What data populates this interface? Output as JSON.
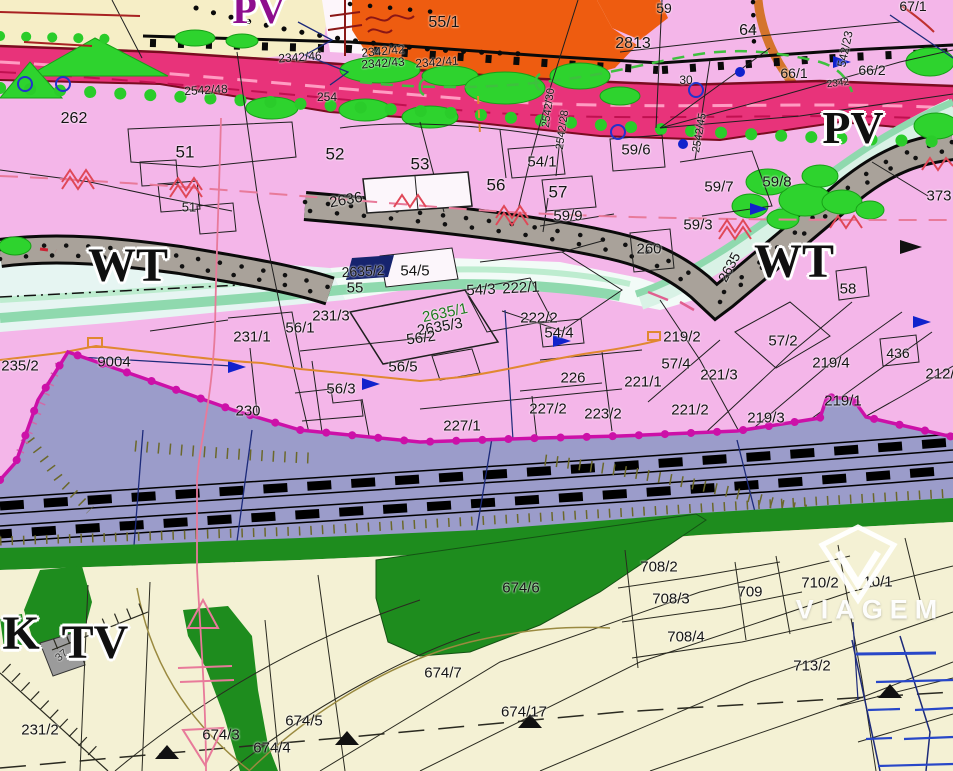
{
  "theme": {
    "zone-pink": "#f4b6e9",
    "zone-rail": "#9b9cca",
    "zone-cream": "#f4f1d4",
    "zone-green": "#1e8c1e",
    "zone-orange": "#ee5c10",
    "zone-yellow": "#f6eec6",
    "zone-white": "#fdf6fb",
    "road-crimson": "#e8337a",
    "road-gray": "#a9a29a",
    "river-mint": "#8fd9ae",
    "river-cyan": "#e6f5f2",
    "boundary-magenta": "#cc10a8",
    "tree-green": "#2ed32e",
    "line-navy": "#1c2a7a",
    "util-orange": "#e08830",
    "line-rose": "#e87a9a",
    "accent-red": "#e04858"
  },
  "map": {
    "watermark": {
      "text": "VIAGEM"
    },
    "zone_labels": [
      {
        "t": "PV",
        "x": 259,
        "y": 10,
        "s": 40,
        "c": "#8e0e8e"
      },
      {
        "t": "PV",
        "x": 853,
        "y": 128,
        "s": 46
      },
      {
        "t": "WT",
        "x": 128,
        "y": 266,
        "s": 48
      },
      {
        "t": "WT",
        "x": 794,
        "y": 262,
        "s": 48
      },
      {
        "t": "K",
        "x": 21,
        "y": 634,
        "s": 48
      },
      {
        "t": "TV",
        "x": 95,
        "y": 643,
        "s": 48
      }
    ],
    "parcel_labels": [
      {
        "t": "2342/46",
        "x": 300,
        "y": 57,
        "r": -4,
        "s": 12
      },
      {
        "t": "2342/42",
        "x": 383,
        "y": 51,
        "r": -5,
        "s": 12
      },
      {
        "t": "2342/43",
        "x": 383,
        "y": 63,
        "r": -4,
        "s": 12
      },
      {
        "t": "2342/41",
        "x": 437,
        "y": 62,
        "r": -4,
        "s": 12
      },
      {
        "t": "2542/48",
        "x": 206,
        "y": 90,
        "r": -3,
        "s": 12
      },
      {
        "t": "254",
        "x": 327,
        "y": 97,
        "s": 12
      },
      {
        "t": "2542/30",
        "x": 549,
        "y": 108,
        "r": -82,
        "s": 11
      },
      {
        "t": "2542/28",
        "x": 563,
        "y": 130,
        "r": -82,
        "s": 11
      },
      {
        "t": "2542/45",
        "x": 700,
        "y": 133,
        "r": -80,
        "s": 11
      },
      {
        "t": "30",
        "x": 686,
        "y": 80,
        "s": 12
      },
      {
        "t": "2342",
        "x": 838,
        "y": 84,
        "r": -6,
        "s": 10
      },
      {
        "t": "542/23",
        "x": 845,
        "y": 49,
        "r": -78,
        "s": 12
      },
      {
        "t": "55/1",
        "x": 444,
        "y": 23,
        "s": 16
      },
      {
        "t": "2813",
        "x": 633,
        "y": 44,
        "s": 16
      },
      {
        "t": "59",
        "x": 664,
        "y": 8,
        "s": 14
      },
      {
        "t": "64",
        "x": 748,
        "y": 31,
        "s": 16
      },
      {
        "t": "67/1",
        "x": 913,
        "y": 6,
        "s": 14
      },
      {
        "t": "66/1",
        "x": 794,
        "y": 73,
        "s": 14
      },
      {
        "t": "66/2",
        "x": 872,
        "y": 70,
        "s": 14
      },
      {
        "t": "262",
        "x": 74,
        "y": 119,
        "s": 16
      },
      {
        "t": "51",
        "x": 185,
        "y": 152,
        "s": 17
      },
      {
        "t": "51",
        "x": 189,
        "y": 207,
        "s": 13
      },
      {
        "t": "52",
        "x": 335,
        "y": 154,
        "s": 17
      },
      {
        "t": "53",
        "x": 420,
        "y": 164,
        "s": 17
      },
      {
        "t": "56",
        "x": 496,
        "y": 185,
        "s": 17
      },
      {
        "t": "54/1",
        "x": 542,
        "y": 162,
        "s": 15
      },
      {
        "t": "57",
        "x": 558,
        "y": 192,
        "s": 17
      },
      {
        "t": "59/9",
        "x": 568,
        "y": 216,
        "s": 15
      },
      {
        "t": "2636",
        "x": 346,
        "y": 200,
        "r": -10,
        "s": 15
      },
      {
        "t": "59/6",
        "x": 636,
        "y": 150,
        "s": 15
      },
      {
        "t": "59/7",
        "x": 719,
        "y": 187,
        "s": 15
      },
      {
        "t": "59/8",
        "x": 777,
        "y": 182,
        "s": 15
      },
      {
        "t": "59/3",
        "x": 698,
        "y": 225,
        "s": 15
      },
      {
        "t": "260",
        "x": 649,
        "y": 249,
        "s": 15
      },
      {
        "t": "2635",
        "x": 729,
        "y": 267,
        "r": -62,
        "s": 14
      },
      {
        "t": "58",
        "x": 848,
        "y": 289,
        "s": 15
      },
      {
        "t": "373",
        "x": 939,
        "y": 196,
        "s": 15
      },
      {
        "t": "2635/2",
        "x": 363,
        "y": 271,
        "r": -3,
        "s": 14
      },
      {
        "t": "54/5",
        "x": 415,
        "y": 271,
        "s": 15
      },
      {
        "t": "55",
        "x": 355,
        "y": 288,
        "s": 15
      },
      {
        "t": "54/3",
        "x": 481,
        "y": 290,
        "r": -3,
        "s": 15
      },
      {
        "t": "222/1",
        "x": 521,
        "y": 288,
        "r": -3,
        "s": 15
      },
      {
        "t": "231/3",
        "x": 331,
        "y": 316,
        "s": 15
      },
      {
        "t": "2635/1",
        "x": 445,
        "y": 313,
        "r": -12,
        "s": 15,
        "c": "#1d7a1d"
      },
      {
        "t": "2635/3",
        "x": 440,
        "y": 327,
        "r": -10,
        "s": 15
      },
      {
        "t": "56/2",
        "x": 421,
        "y": 338,
        "r": -8,
        "s": 15
      },
      {
        "t": "56/1",
        "x": 300,
        "y": 328,
        "s": 15
      },
      {
        "t": "222/2",
        "x": 539,
        "y": 318,
        "s": 15
      },
      {
        "t": "54/4",
        "x": 559,
        "y": 333,
        "s": 15
      },
      {
        "t": "56/5",
        "x": 403,
        "y": 367,
        "s": 15
      },
      {
        "t": "56/3",
        "x": 341,
        "y": 389,
        "s": 15
      },
      {
        "t": "226",
        "x": 573,
        "y": 378,
        "s": 15
      },
      {
        "t": "227/2",
        "x": 548,
        "y": 409,
        "s": 15
      },
      {
        "t": "223/2",
        "x": 603,
        "y": 414,
        "s": 15
      },
      {
        "t": "227/1",
        "x": 462,
        "y": 426,
        "s": 15
      },
      {
        "t": "221/1",
        "x": 643,
        "y": 382,
        "s": 15
      },
      {
        "t": "221/3",
        "x": 719,
        "y": 375,
        "s": 15
      },
      {
        "t": "57/4",
        "x": 676,
        "y": 364,
        "s": 15
      },
      {
        "t": "219/2",
        "x": 682,
        "y": 337,
        "s": 15
      },
      {
        "t": "57/2",
        "x": 783,
        "y": 341,
        "s": 15
      },
      {
        "t": "219/4",
        "x": 831,
        "y": 363,
        "s": 15
      },
      {
        "t": "436",
        "x": 898,
        "y": 353,
        "s": 14
      },
      {
        "t": "212/",
        "x": 940,
        "y": 374,
        "s": 15
      },
      {
        "t": "221/2",
        "x": 690,
        "y": 410,
        "s": 15
      },
      {
        "t": "219/3",
        "x": 766,
        "y": 418,
        "s": 15
      },
      {
        "t": "219/1",
        "x": 843,
        "y": 401,
        "s": 15
      },
      {
        "t": "235/2",
        "x": 20,
        "y": 366,
        "s": 15
      },
      {
        "t": "9004",
        "x": 114,
        "y": 362,
        "s": 15
      },
      {
        "t": "231/1",
        "x": 252,
        "y": 337,
        "s": 15
      },
      {
        "t": "230",
        "x": 248,
        "y": 411,
        "s": 15
      },
      {
        "t": "674/6",
        "x": 521,
        "y": 588,
        "s": 15
      },
      {
        "t": "708/2",
        "x": 659,
        "y": 567,
        "s": 15
      },
      {
        "t": "708/3",
        "x": 671,
        "y": 599,
        "s": 15
      },
      {
        "t": "709",
        "x": 750,
        "y": 592,
        "s": 15
      },
      {
        "t": "710/2",
        "x": 820,
        "y": 583,
        "s": 15
      },
      {
        "t": "10/1",
        "x": 878,
        "y": 582,
        "s": 15
      },
      {
        "t": "708/4",
        "x": 686,
        "y": 637,
        "s": 15
      },
      {
        "t": "713/2",
        "x": 812,
        "y": 666,
        "s": 15
      },
      {
        "t": "674/7",
        "x": 443,
        "y": 673,
        "s": 15
      },
      {
        "t": "674/17",
        "x": 524,
        "y": 712,
        "s": 15
      },
      {
        "t": "674/5",
        "x": 304,
        "y": 721,
        "s": 15
      },
      {
        "t": "674/4",
        "x": 272,
        "y": 748,
        "s": 15
      },
      {
        "t": "674/3",
        "x": 221,
        "y": 735,
        "s": 15
      },
      {
        "t": "231/2",
        "x": 40,
        "y": 730,
        "s": 15
      },
      {
        "t": "37",
        "x": 62,
        "y": 656,
        "r": -40,
        "s": 11,
        "c": "#333333"
      }
    ]
  }
}
